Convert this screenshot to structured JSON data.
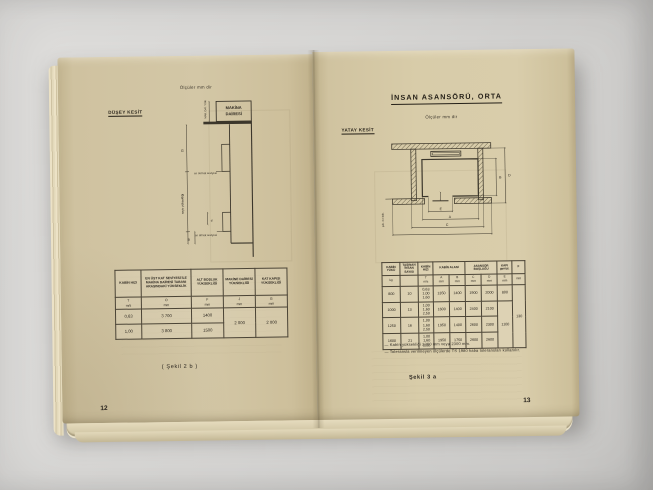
{
  "left_page": {
    "section_label": "DÜŞEY KESİT",
    "units_note": "Ölçüler mm dir",
    "diagram": {
      "machine_room_line1": "MAKİNA",
      "machine_room_line2": "DAİRESİ",
      "machine_dim_note": "MAK. DAİ. YÜK.",
      "dim_g": "G",
      "dim_d": "d",
      "dim_b": "B",
      "travel_label": "seyir yüksekliği",
      "top_level": "en üst kat seviyesi",
      "bottom_level": "en alt kat seviyesi"
    },
    "table": {
      "headers": [
        "KABİN HIZI",
        "EN ÜST KAT SEVİYESİ İLE MAKİNA DAİRESİ TABANI ARASINDAKİ YÜKSEKLİK",
        "ALT BOŞLUK YÜKSEKLİĞİ",
        "MAKİNE DAİRESİ YÜKSEKLİĞİ",
        "KAT KAPISI YÜKSEKLİĞİ"
      ],
      "subs": [
        "T\nm/s",
        "O\nmm",
        "F\nmm",
        "J\nmm",
        "G\nmm"
      ],
      "rows": [
        [
          "0,63",
          "3 700",
          "1400"
        ],
        [
          "1,00",
          "3 800",
          "1500"
        ]
      ],
      "merged": {
        "machine_height": "2 000",
        "door_height": "2 000"
      }
    },
    "caption": "( Şekil 2 b )",
    "page_number": "12"
  },
  "right_page": {
    "title": "İNSAN ASANSÖRÜ, ORTA",
    "units_note": "Ölçüler mm dir",
    "section_label": "YATAY KESİT",
    "diagram": {
      "dim_a": "A",
      "dim_b": "B",
      "dim_c": "C",
      "dim_d": "D",
      "dim_e": "E",
      "side_note": "şek. 4 e bak."
    },
    "table": {
      "headers": {
        "load": "KABİN YÜKÜ",
        "persons": "TAŞINAN İNSAN SAYISI",
        "speed": "KABİN HIZI",
        "cabin_area": "KABİN ALANI",
        "shaft": "ASANSÖR BOŞLUĞU",
        "door": "KAPI genişl.",
        "f": "F"
      },
      "subs": [
        "kg",
        "",
        "T\nm/s",
        "A\nmm",
        "B\nmm",
        "C\nmm",
        "D\nmm",
        "E\nmm",
        "mm"
      ],
      "rows": [
        [
          "800",
          "10",
          "0,63\n1,00\n1,60",
          "1350",
          "1400",
          "1900",
          "2000",
          "800"
        ],
        [
          "1000",
          "13",
          "1,00\n1,60\n2,50",
          "1600",
          "1400",
          "2400",
          "2100"
        ],
        [
          "1250",
          "16",
          "1,00\n1,60\n2,50",
          "1950",
          "1400",
          "2600",
          "2300"
        ],
        [
          "1600",
          "21",
          "1,00\n1,60\n2,50",
          "1950",
          "1750",
          "2600",
          "2600"
        ]
      ],
      "merged": {
        "door_width": "1100",
        "f_value": "130"
      }
    },
    "notes": [
      "— Kabin yüksekliği 2200 mm veya 2300 mm.",
      "— Toleransla verilmeyen ölçülerde TS 1980 kaba toleransları kullanılır."
    ],
    "caption": "Şekil 3 a",
    "page_number": "13"
  }
}
